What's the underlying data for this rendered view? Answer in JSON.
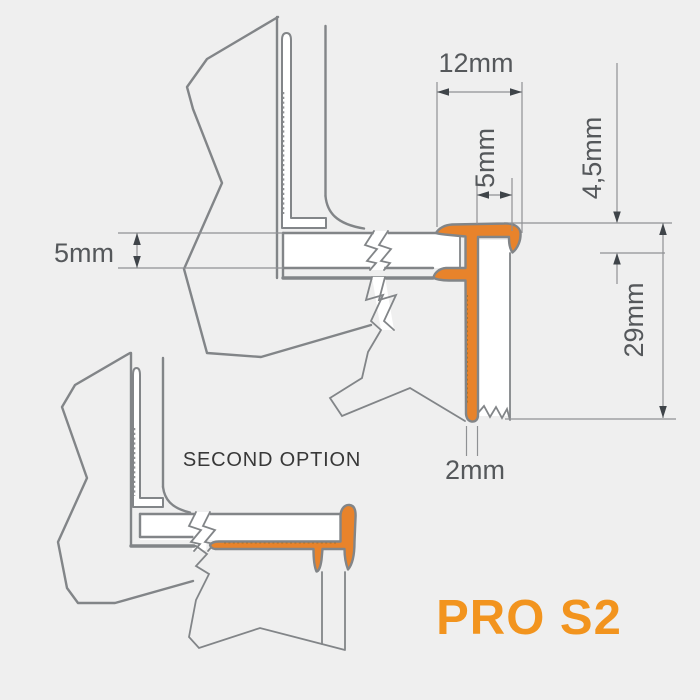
{
  "meta": {
    "title": "PRO S2 tile edge profile technical drawing",
    "type": "technical-diagram"
  },
  "colors": {
    "background": "#efefef",
    "outline": "#828588",
    "thin_line": "#8f9194",
    "arrow": "#3f4449",
    "dimension_text": "#55585b",
    "profile_fill": "#e8832b",
    "tile_fill": "#ffffff",
    "logo_orange": "#f2941e",
    "label_text": "#383838"
  },
  "dimensions": {
    "cap_width": "12mm",
    "channel_width": "5mm",
    "nose_height": "4,5mm",
    "anchor_length": "29mm",
    "anchor_thickness": "2mm",
    "tile_thickness": "5mm"
  },
  "labels": {
    "second_option": "SECOND OPTION",
    "product_name": "PRO S2"
  }
}
